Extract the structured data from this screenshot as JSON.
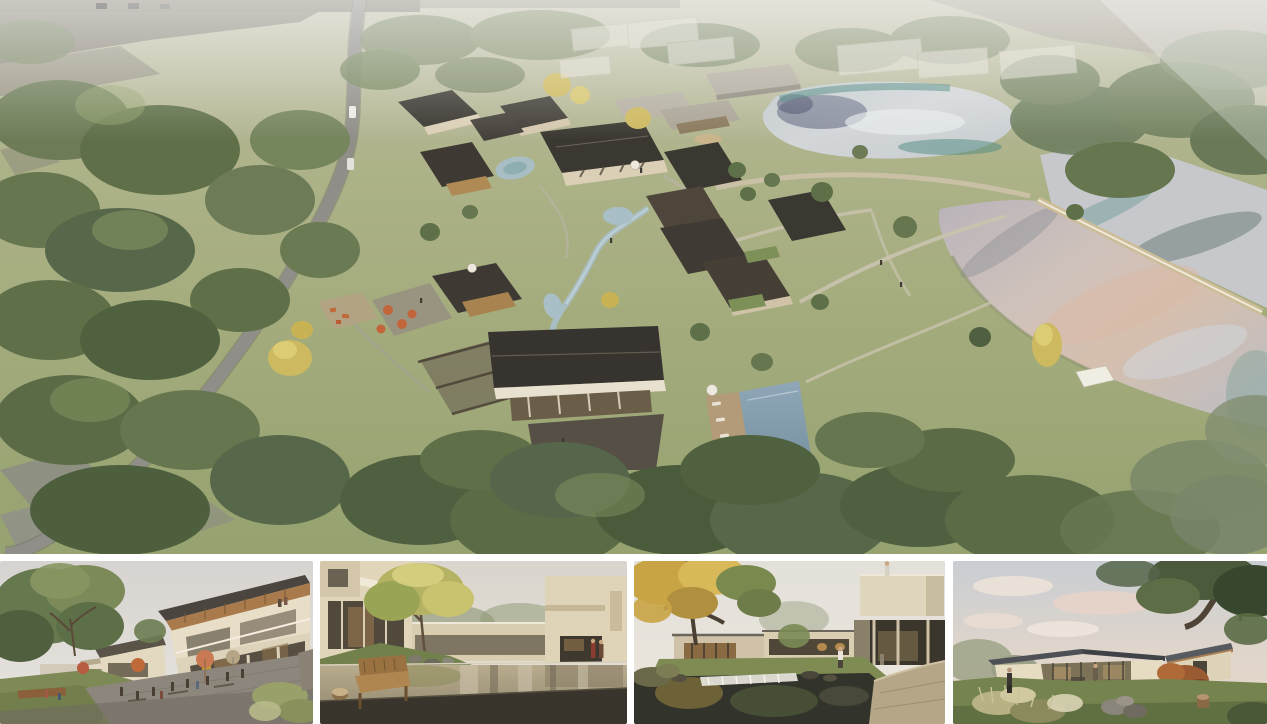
{
  "board": {
    "label": "Architectural rendering presentation board",
    "background": "#ffffff"
  },
  "hero": {
    "label": "Aerial rendering of a lakeside courtyard-house village masterplan",
    "features": [
      "winding-access-road",
      "parking-strip",
      "village-cluster-pitched-roofs",
      "central-hall",
      "swimming-pool",
      "pool-deck",
      "stream-and-ponds",
      "cafe-terrace-umbrellas",
      "playground",
      "upper-pond",
      "lower-lake",
      "weir-walkway",
      "shade-sail",
      "meadow-paths",
      "ghosted-future-buildings",
      "forest-edge",
      "terraced-stone-walls"
    ]
  },
  "thumbnails": [
    {
      "id": "plaza",
      "label": "Street-level view of two-storey shop houses around a plaza with cafe umbrellas"
    },
    {
      "id": "courtyard-pool",
      "label": "Courtyard with reflecting pool, wooden bench and golden tree"
    },
    {
      "id": "pond-cascade",
      "label": "Garden court with pond cascade below a cantilevered guest wing"
    },
    {
      "id": "pavilion-dusk",
      "label": "Single-storey glass pavilion on a lawn at dusk"
    }
  ],
  "palette": {
    "gap_white": "#ffffff",
    "grass": "#a3ab7c",
    "meadow_light": "#bcc091",
    "forest_green": "#546545",
    "roof_dark": "#3b3731",
    "wall_cream": "#dbcfb6",
    "road_gray": "#8f8e88",
    "path_tan": "#c9c3ae",
    "water_silver": "#d3d6d8",
    "water_teal": "#4f8a80",
    "water_pink": "#dcb9a6",
    "pool_blue": "#829bac",
    "stream_blue": "#a9bfc7",
    "umbrella_orange": "#c2653a",
    "foliage_gold": "#cdb95f",
    "deck_wood": "#b39b79",
    "paving_dark": "#564f45",
    "sky_pale": "#dcd8d2",
    "dusk_pink": "#e6d8cb"
  }
}
